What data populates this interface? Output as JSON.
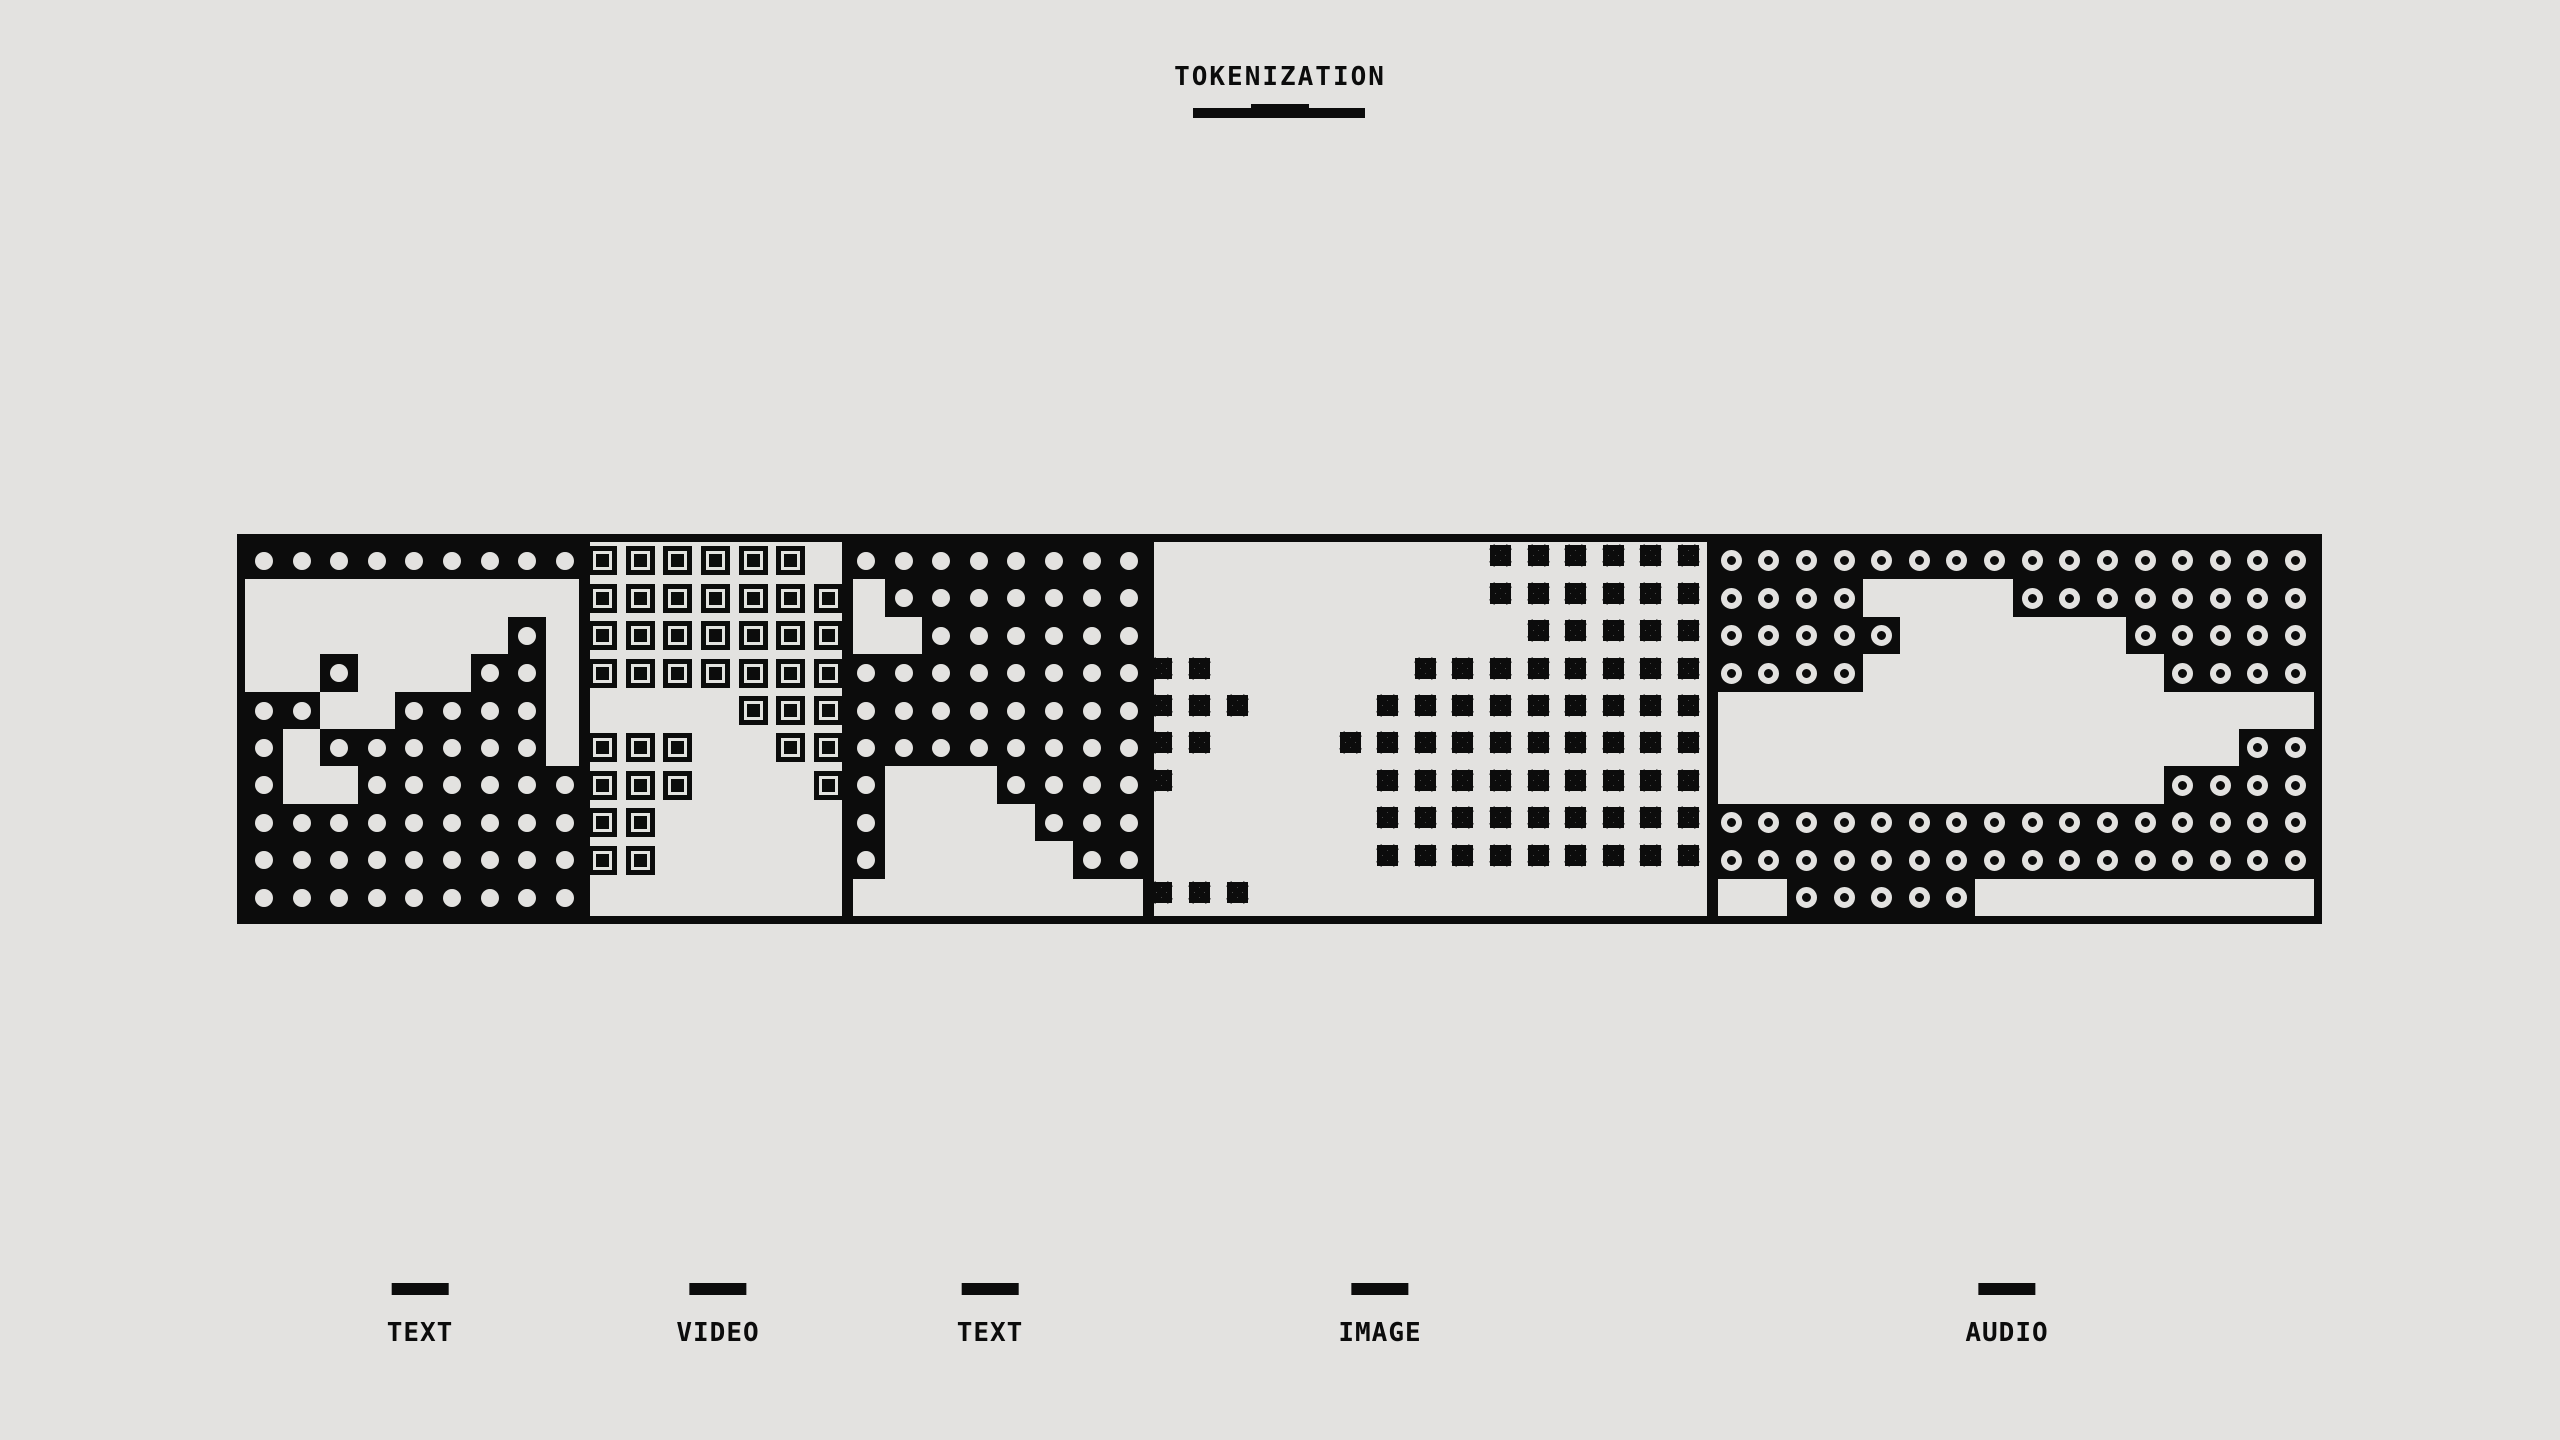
{
  "colors": {
    "ink": "#0c0c0c",
    "paper": "#e3e2e0"
  },
  "header": {
    "title": "TOKENIZATION"
  },
  "band": {
    "rows": 10,
    "cols": 55,
    "cell_types": {
      "d": "text-token-dot",
      "s": "video-token-square",
      "x": "image-token-xbox",
      "o": "audio-token-ring",
      ".": "empty"
    },
    "segments": [
      {
        "label": "TEXT",
        "start_col": 0,
        "end_col": 8
      },
      {
        "label": "VIDEO",
        "start_col": 9,
        "end_col": 15
      },
      {
        "label": "TEXT",
        "start_col": 16,
        "end_col": 23
      },
      {
        "label": "IMAGE",
        "start_col": 24,
        "end_col": 38
      },
      {
        "label": "AUDIO",
        "start_col": 39,
        "end_col": 54
      }
    ],
    "grid": [
      "dddddddddssssss.dddddddd.........xxxxxxoooooooooooooooo",
      ".........sssssss.ddddddd.........xxxxxxoooo....oooooooo",
      ".......d.sssssss..dddddd..........xxxxxooooo......ooooo",
      "..d...dd.sssssssddddddddxx.....xxxxxxxxoooo........oooo",
      "dd..dddd.....sssddddddddxxx...xxxxxxxxx................",
      "d.dddddd.sss..ssddddddddxx...xxxxxxxxxx..............oo",
      "d..ddddddsss...sd...ddddx.....xxxxxxxxx............oooo",
      "dddddddddss.....d....ddd......xxxxxxxxxoooooooooooooooo",
      "dddddddddss.....d.....dd......xxxxxxxxxoooooooooooooooo",
      "ddddddddd...............xxx..............ooooo........."
    ]
  },
  "legend": {
    "items": [
      {
        "label": "TEXT",
        "x": 420
      },
      {
        "label": "VIDEO",
        "x": 718
      },
      {
        "label": "TEXT",
        "x": 990
      },
      {
        "label": "IMAGE",
        "x": 1380
      },
      {
        "label": "AUDIO",
        "x": 2007
      }
    ]
  }
}
